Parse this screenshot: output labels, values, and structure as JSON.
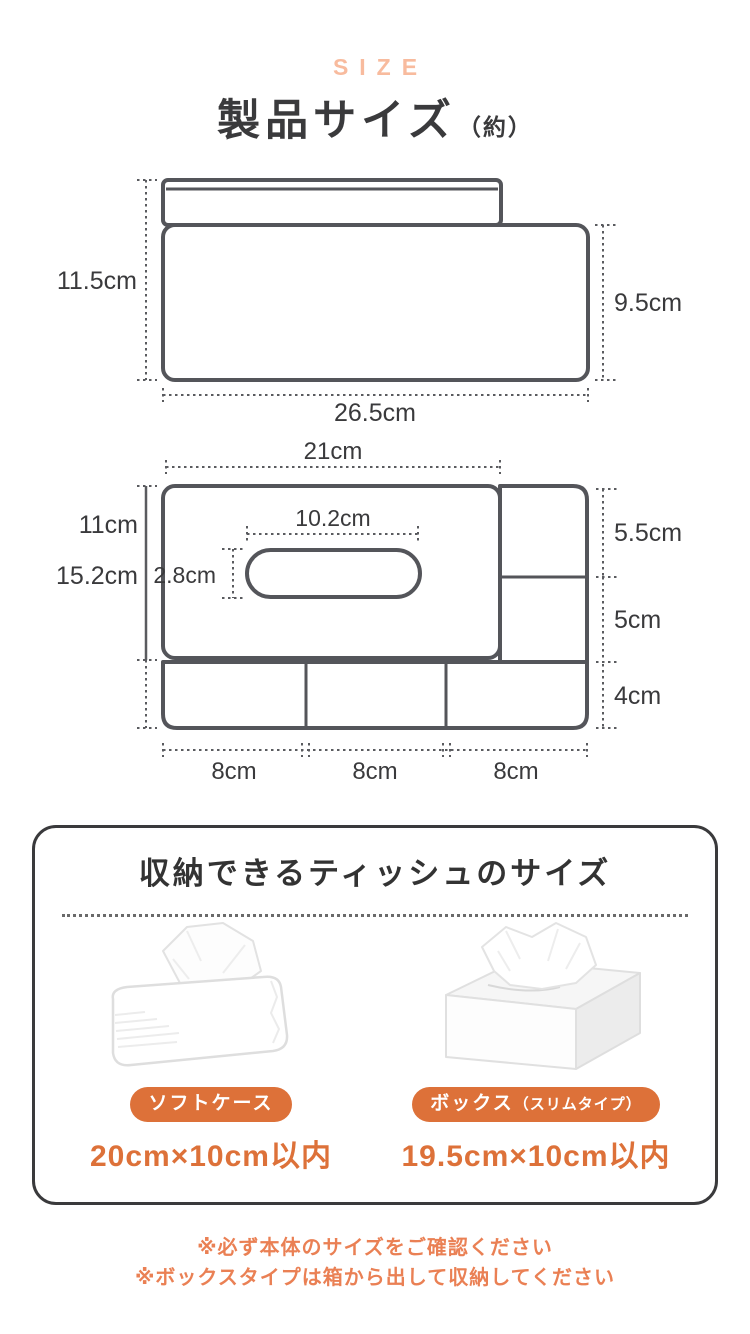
{
  "header": {
    "eyebrow": "SIZE",
    "title": "製品サイズ",
    "title_note": "（約）"
  },
  "side_view": {
    "height_total": "11.5cm",
    "height_body": "9.5cm",
    "width_bottom": "26.5cm"
  },
  "front_view": {
    "width_top": "21cm",
    "height_front": "11cm",
    "height_total": "15.2cm",
    "slot_width": "10.2cm",
    "slot_height": "2.8cm",
    "side_section_top": "5.5cm",
    "side_section_middle": "5cm",
    "bottom_flap_height": "4cm",
    "bottom_cells": [
      "8cm",
      "8cm",
      "8cm"
    ]
  },
  "tissue_card": {
    "title": "収納できるティッシュのサイズ",
    "items": [
      {
        "badge": "ソフトケース",
        "badge_note": "",
        "size": "20cm×10cm以内"
      },
      {
        "badge": "ボックス",
        "badge_note": "（スリムタイプ）",
        "size": "19.5cm×10cm以内"
      }
    ]
  },
  "notes": [
    "※必ず本体のサイズをご確認ください",
    "※ボックスタイプは箱から出して収納してください"
  ],
  "colors": {
    "accent_orange": "#DD7139",
    "note_orange": "#EA8054",
    "eyebrow_pink": "#F8BB9E",
    "line_gray": "#54555A",
    "text_dark": "#3A3A3C"
  }
}
